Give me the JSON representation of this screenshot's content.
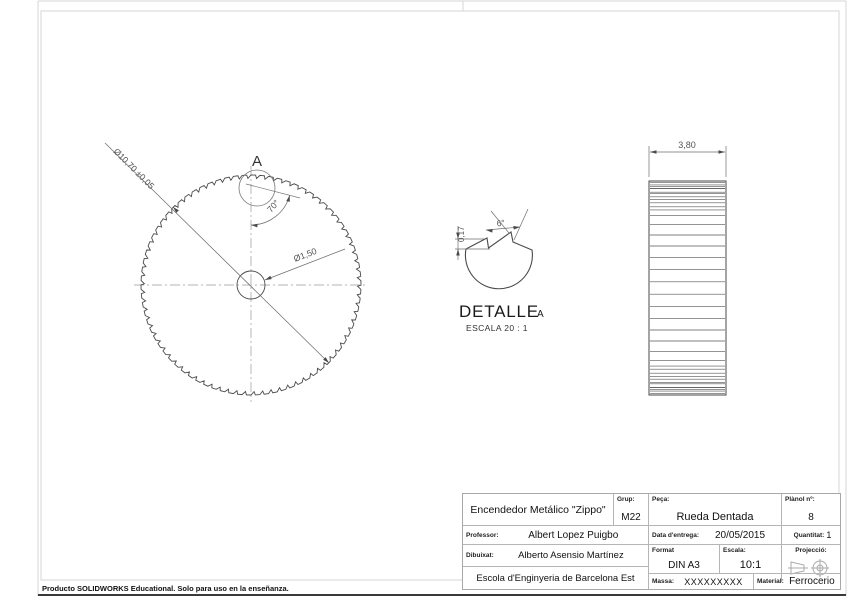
{
  "sheet": {
    "footer": "Producto SOLIDWORKS Educational. Solo para uso en la enseñanza."
  },
  "front_view": {
    "detail_label": "A",
    "dim_diameter": "Ø10,70 ±0,05",
    "dim_hole": "Ø1,50",
    "dim_angle": "70°"
  },
  "detail_view": {
    "title": "DETALLE",
    "ref": "A",
    "scale": "ESCALA 20 : 1",
    "dim_angle": "6°",
    "dim_depth": "0,17"
  },
  "side_view": {
    "dim_width": "3,80"
  },
  "title_block": {
    "project": "Encendedor Metálico \"Zippo\"",
    "grup_label": "Grup:",
    "grup": "M22",
    "peca_label": "Peça:",
    "peca": "Rueda Dentada",
    "planol_label": "Plànol nº:",
    "planol": "8",
    "professor_label": "Professor:",
    "professor": "Albert Lopez Puigbo",
    "data_label": "Data d'entrega:",
    "data": "20/05/2015",
    "quantitat_label": "Quantitat:",
    "quantitat": "1",
    "dibuixat_label": "Dibuixat:",
    "dibuixat": "Alberto Asensio Martínez",
    "format_label": "Format",
    "format": "DIN A3",
    "escala_label": "Escala:",
    "escala": "10:1",
    "projeccio_label": "Projecció:",
    "escola": "Escola d'Enginyeria de Barcelona Est",
    "massa_label": "Massa:",
    "massa": "XXXXXXXXX",
    "material_label": "Material:",
    "material": "Ferrocerio"
  },
  "colors": {
    "drawing_line": "#4a4a4a",
    "dimension_line": "#6e6e6e",
    "centerline": "#9a9a9a",
    "frame_line": "#d6d6d6"
  }
}
